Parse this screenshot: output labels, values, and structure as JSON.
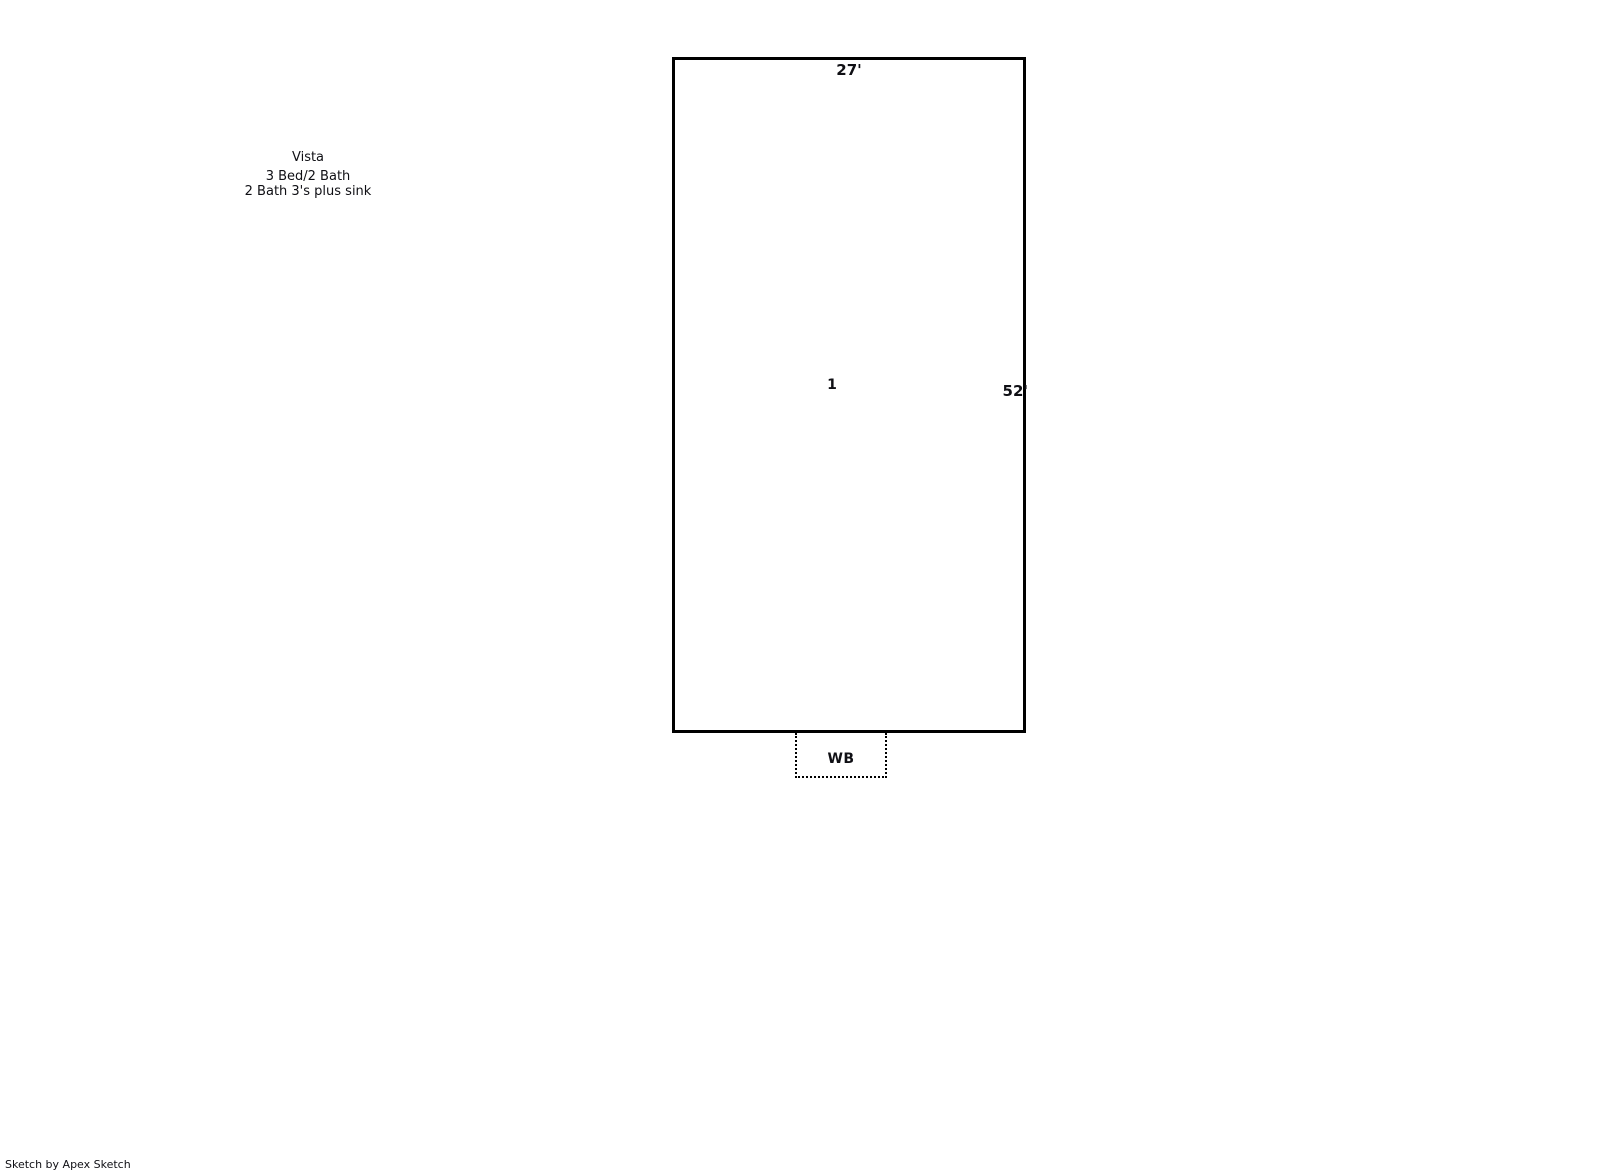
{
  "colors": {
    "background": "#ffffff",
    "line": "#000000",
    "text": "#0f0f14"
  },
  "annotation": {
    "lines": [
      "Vista",
      "3 Bed/2 Bath",
      "2 Bath 3's plus sink"
    ]
  },
  "room": {
    "area_number": "1",
    "top_dimension": "27'",
    "right_dimension": "52'"
  },
  "attachment": {
    "label": "WB"
  },
  "footer": {
    "credit": "Sketch by Apex Sketch"
  }
}
